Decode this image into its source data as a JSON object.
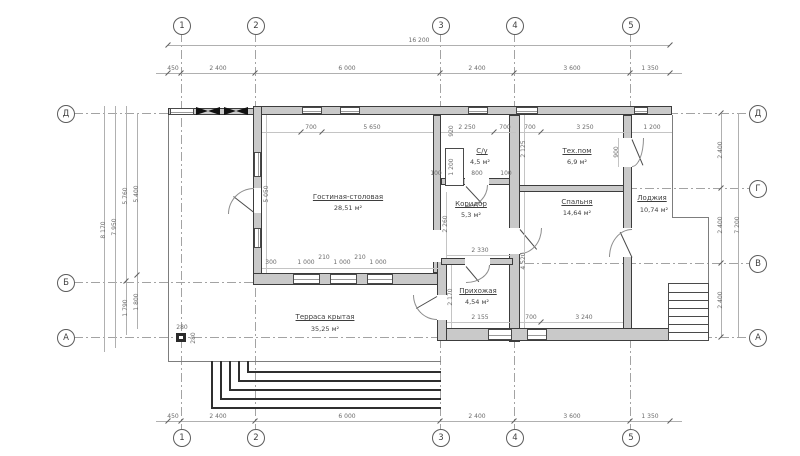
{
  "axes": {
    "cols": [
      "1",
      "2",
      "3",
      "4",
      "5"
    ],
    "left": [
      "Д",
      "Б",
      "А"
    ],
    "right": [
      "Д",
      "Г",
      "В",
      "А"
    ]
  },
  "dims": {
    "total_width": "16 200",
    "chain": [
      "450",
      "2 400",
      "6 000",
      "2 400",
      "3 600",
      "1 350"
    ],
    "left": {
      "h_total": "8 170",
      "h_wall": "7 950",
      "seg_a": "5 760",
      "seg_b": "1 790",
      "ax_a": "5 400",
      "ax_b": "1 800"
    },
    "right": {
      "seg": [
        "2 400",
        "2 400",
        "2 400"
      ],
      "total": "7 200"
    },
    "inner": {
      "living_top_a": "700",
      "living_top_b": "5 650",
      "living_left": "5 050",
      "living_bot": [
        "300",
        "1 000",
        "210",
        "1 000",
        "210",
        "1 000"
      ],
      "wc_top_a": "2 250",
      "wc_top_b": "700",
      "wc_shaft_a": "920",
      "wc_shaft_b": "1 200",
      "wc_door": [
        "100",
        "800",
        "100"
      ],
      "tech_top_a": "700",
      "tech_top_b": "3 250",
      "tech_left": "2 125",
      "tech_door": "900",
      "loggia_top": "1 200",
      "corridor_left": "2 260",
      "hall_top": "2 330",
      "hall_left": "2 170",
      "hall_bot": "2 155",
      "bed_bot_a": "700",
      "bed_bot_b": "3 240",
      "bed_left": "4 520",
      "post_a": "280",
      "post_b": "280"
    }
  },
  "rooms": {
    "living": {
      "name": "Гостиная-столовая",
      "area": "28,51 м²"
    },
    "wc": {
      "name": "С/у",
      "area": "4,5 м²"
    },
    "tech": {
      "name": "Тех.пом",
      "area": "6,9 м²"
    },
    "corridor": {
      "name": "Коридор",
      "area": "5,3 м²"
    },
    "bedroom": {
      "name": "Спальня",
      "area": "14,64 м²"
    },
    "loggia": {
      "name": "Лоджия",
      "area": "10,74 м²"
    },
    "hall": {
      "name": "Прихожая",
      "area": "4,54 м²"
    },
    "terrace": {
      "name": "Терраса крытая",
      "area": "35,25 м²"
    }
  }
}
